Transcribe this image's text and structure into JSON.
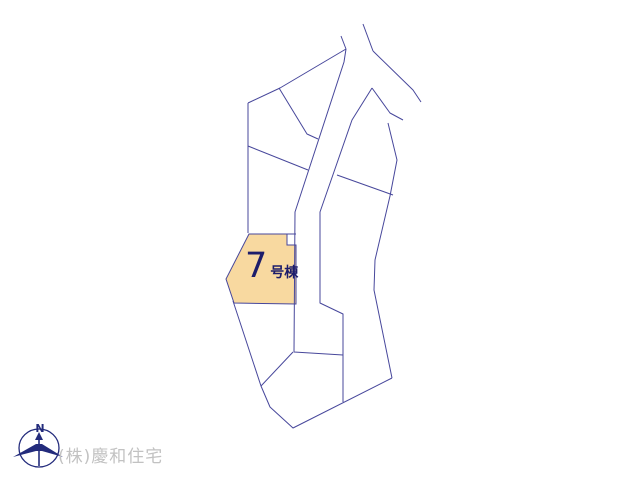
{
  "colors": {
    "background": "#ffffff",
    "line": "#47479b",
    "highlight_fill": "#f8d9a0",
    "lot_label": "#1d1d6b",
    "company_text": "#c2c2c2",
    "compass": "#232b7c"
  },
  "lot": {
    "number": "7",
    "suffix": "号棟"
  },
  "company": {
    "name": "(株)慶和住宅"
  },
  "compass": {
    "north_label": "N"
  },
  "map": {
    "width": 640,
    "height": 480,
    "highlight_polygon": [
      [
        249,
        234
      ],
      [
        287,
        234
      ],
      [
        287,
        245
      ],
      [
        296,
        245
      ],
      [
        296,
        304
      ],
      [
        234,
        303
      ],
      [
        226,
        279
      ]
    ],
    "polylines": [
      [
        [
          341,
          36
        ],
        [
          346,
          49
        ]
      ],
      [
        [
          363,
          24
        ],
        [
          373,
          51
        ]
      ],
      [
        [
          373,
          51
        ],
        [
          413,
          90
        ],
        [
          421,
          102
        ]
      ],
      [
        [
          346,
          49
        ],
        [
          280,
          88
        ],
        [
          248,
          103
        ]
      ],
      [
        [
          248,
          103
        ],
        [
          248,
          233
        ]
      ],
      [
        [
          279,
          88
        ],
        [
          307,
          134
        ],
        [
          318,
          139
        ]
      ],
      [
        [
          248,
          146
        ],
        [
          308,
          170
        ]
      ],
      [
        [
          346,
          49
        ],
        [
          344,
          62
        ],
        [
          295,
          212
        ],
        [
          294,
          352
        ],
        [
          343,
          355
        ]
      ],
      [
        [
          372,
          88
        ],
        [
          352,
          120
        ],
        [
          320,
          212
        ],
        [
          320,
          303
        ],
        [
          343,
          314
        ],
        [
          343,
          402
        ]
      ],
      [
        [
          372,
          88
        ],
        [
          390,
          113
        ],
        [
          403,
          120
        ]
      ],
      [
        [
          388,
          123
        ],
        [
          397,
          160
        ],
        [
          390,
          196
        ],
        [
          375,
          260
        ],
        [
          374,
          290
        ],
        [
          392,
          378
        ]
      ],
      [
        [
          337,
          175
        ],
        [
          393,
          195
        ]
      ],
      [
        [
          233,
          301
        ],
        [
          261,
          386
        ],
        [
          270,
          407
        ],
        [
          293,
          428
        ],
        [
          392,
          378
        ]
      ],
      [
        [
          293,
          352
        ],
        [
          261,
          386
        ]
      ],
      [
        [
          287,
          234
        ],
        [
          296,
          234
        ]
      ]
    ]
  }
}
